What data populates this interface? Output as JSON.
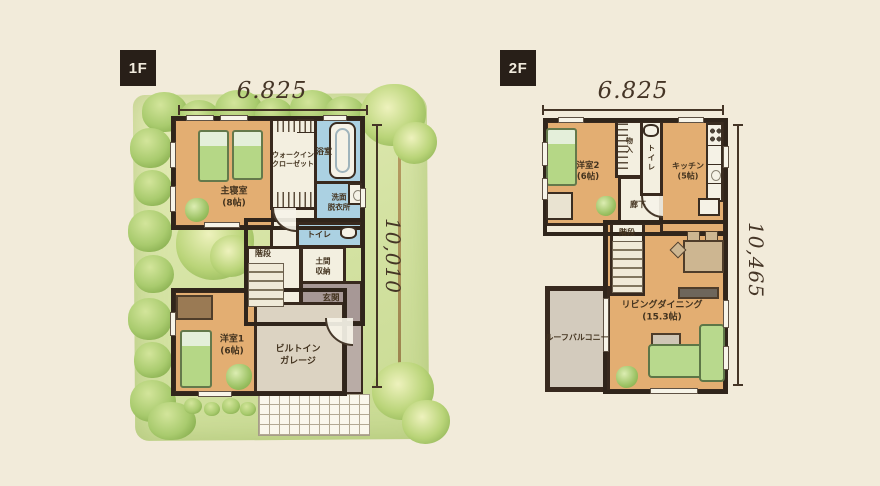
{
  "colors": {
    "background": "#f2ebda",
    "wall": "#38291e",
    "room_tan": "#e3ae72",
    "room_blue": "#abd1e2",
    "room_white": "#f3efe0",
    "garage_gray": "#dcd3c2",
    "balcony_gray": "#d3cbbd",
    "entrance_gray": "#a79896",
    "garden_green": "#d5e3a4",
    "hedge_green": "#a9cb6e",
    "furniture_green": "#b5d786",
    "dim_text": "#453526",
    "badge_bg": "#281f18",
    "badge_text": "#f1ebdd"
  },
  "floor1": {
    "badge": "1F",
    "dim_width": "6.825",
    "dim_depth": "10,010",
    "rooms": {
      "master_bedroom": "主寝室\n(8帖)",
      "walk_in_closet": "ウォークイン\nクローゼット",
      "bathroom": "浴室",
      "washroom": "洗面\n脱衣所",
      "toilet": "トイレ",
      "stairs": "階段",
      "doma_storage": "土間\n収納",
      "entrance": "玄関",
      "western_room1": "洋室1\n(6帖)",
      "garage": "ビルトイン\nガレージ"
    }
  },
  "floor2": {
    "badge": "2F",
    "dim_width": "6.825",
    "dim_depth": "10,465",
    "rooms": {
      "western_room2": "洋室2\n(6帖)",
      "storage": "物入",
      "toilet": "トイレ",
      "kitchen": "キッチン\n(5帖)",
      "hallway": "廊下",
      "stairs": "階段",
      "living_dining": "リビングダイニング\n(15.3帖)",
      "roof_balcony": "ルーフバルコニー"
    }
  }
}
